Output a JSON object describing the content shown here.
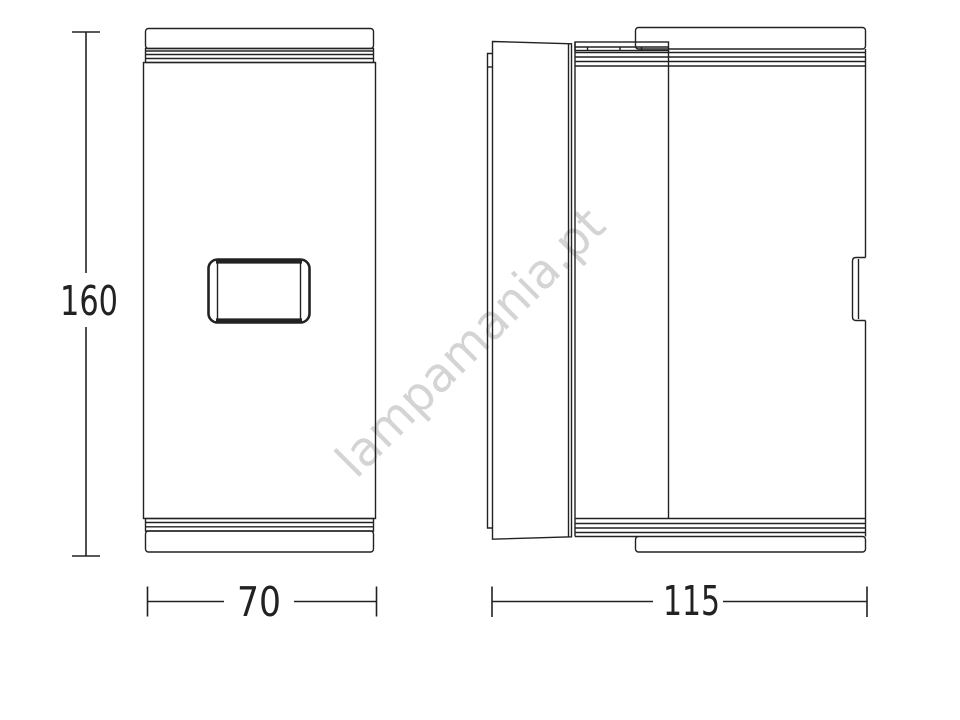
{
  "diagram": {
    "background_color": "#ffffff",
    "line_color": "#222222",
    "watermark": {
      "text": "lampamania.pt",
      "color": "#d4d4d4",
      "rotation_deg": -45
    },
    "views": {
      "front": {
        "dimensions": {
          "height_label": "160",
          "width_label": "70"
        }
      },
      "side": {
        "dimensions": {
          "depth_label": "115"
        }
      }
    }
  }
}
